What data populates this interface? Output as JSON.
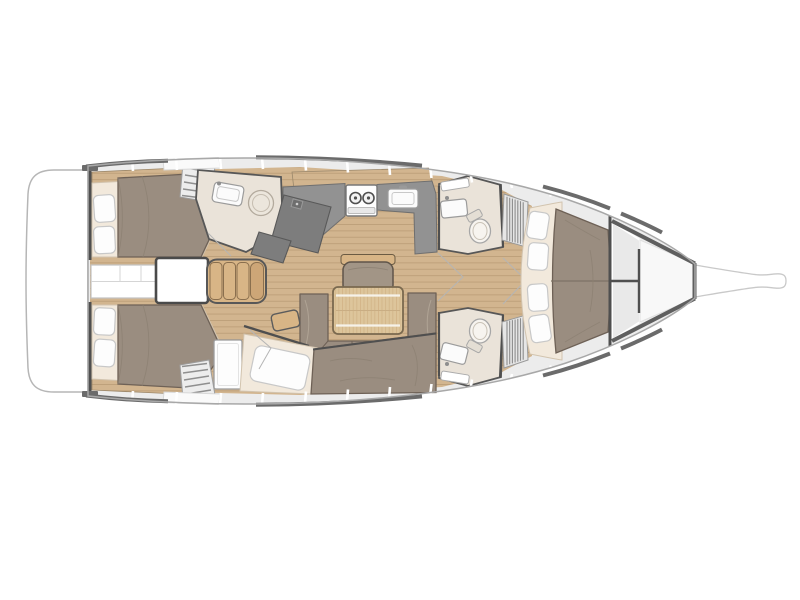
{
  "meta": {
    "title": "Sailing yacht interior deck plan, top view, bow pointing right",
    "diagram_type": "yacht-floor-plan",
    "orientation": "bow-right",
    "background": "#ffffff",
    "visible_text": ""
  },
  "colors": {
    "deck": "#ececec",
    "hull-line": "#a8a8a8",
    "rail": "#6b6b6b",
    "wall": "#4f4f4f",
    "wood": "#d2b58f",
    "wood-line": "#bd9f79",
    "table-wood": "#ddc59b",
    "settee": "#d8b586",
    "uphol": "#9a8d80",
    "cream": "#f2e9dc",
    "counter": "#929292",
    "counter-dark": "#7d7d7d",
    "headfloor": "#eae3d9"
  },
  "areas": [
    {
      "id": "swim-platform",
      "label": "transom swim platform"
    },
    {
      "id": "aft-cabin-port",
      "label": "aft double cabin (top)"
    },
    {
      "id": "aft-cabin-starboard",
      "label": "aft double cabin (bottom)"
    },
    {
      "id": "aft-corridor",
      "label": "berth infill between aft cabins"
    },
    {
      "id": "engine-box",
      "label": "companionway / engine box"
    },
    {
      "id": "settee-bench",
      "label": "four-cushion settee bench"
    },
    {
      "id": "aft-head",
      "label": "aft head with sink and shower"
    },
    {
      "id": "nav-station",
      "label": "chart table / nav station"
    },
    {
      "id": "galley",
      "label": "galley with stove and sink"
    },
    {
      "id": "saloon-table",
      "label": "saloon table"
    },
    {
      "id": "saloon-sofa",
      "label": "U-shaped saloon sofa"
    },
    {
      "id": "armchair",
      "label": "saloon armchair"
    },
    {
      "id": "side-pouf",
      "label": "small side stool"
    },
    {
      "id": "mid-cabin",
      "label": "mid berth cabin (bottom)"
    },
    {
      "id": "fwd-head-top",
      "label": "forward head (top) with toilet"
    },
    {
      "id": "fwd-head-bottom",
      "label": "forward head (bottom) with toilet"
    },
    {
      "id": "louver-lockers",
      "label": "louvered lockers"
    },
    {
      "id": "fore-cabin",
      "label": "forward owner cabin with V-berth"
    },
    {
      "id": "anchor-locker",
      "label": "bow anchor locker"
    },
    {
      "id": "bowsprit",
      "label": "bowsprit"
    },
    {
      "id": "companionway-stairs",
      "label": "companionway steps"
    }
  ]
}
